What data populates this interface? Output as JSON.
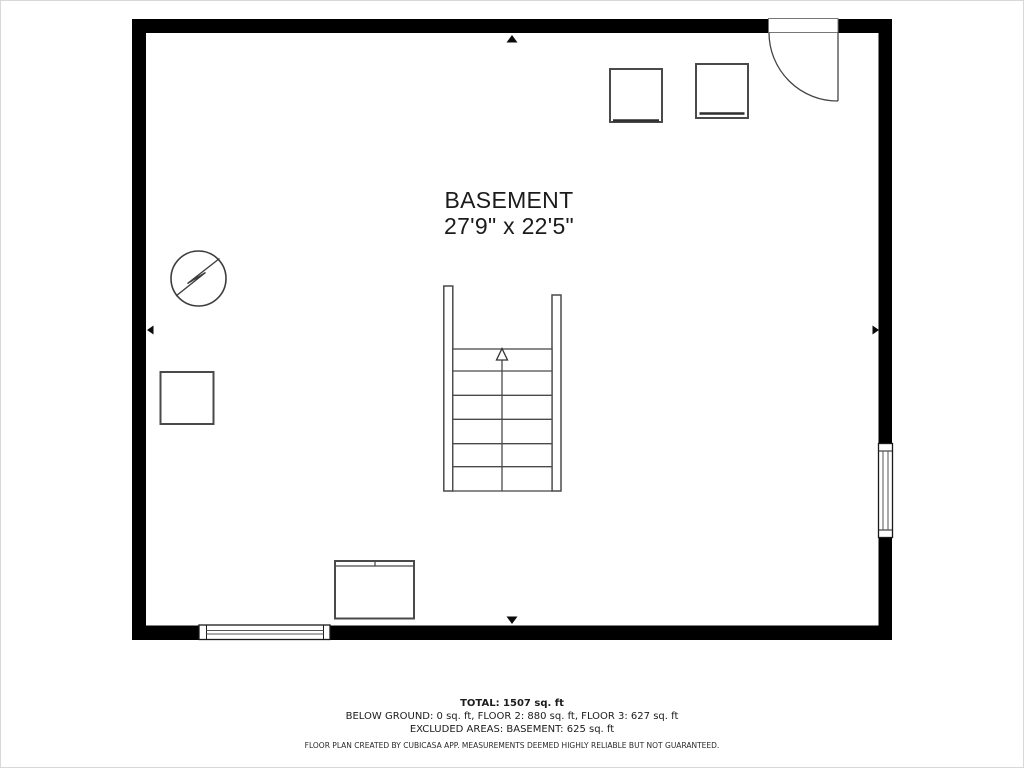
{
  "room": {
    "label": "BASEMENT",
    "dimensions": "27'9\" x 22'5\""
  },
  "footer": {
    "total": "TOTAL: 1507 sq. ft",
    "breakdown": "BELOW GROUND: 0 sq. ft, FLOOR 2: 880 sq. ft, FLOOR 3: 627 sq. ft",
    "excluded": "EXCLUDED AREAS: BASEMENT: 625 sq. ft",
    "disclaimer": "FLOOR PLAN CREATED BY CUBICASA APP. MEASUREMENTS DEEMED HIGHLY RELIABLE BUT NOT GUARANTEED."
  },
  "icons": {
    "electrical": "circle-lightning-bolt-symbol",
    "stairs": "staircase-with-up-arrow",
    "door": "quarter-swing-door-top-right",
    "windows": [
      "bottom-wall-window",
      "right-wall-window"
    ],
    "wall_markers": "midpoint-arrow-triangles",
    "furniture": [
      "appliance-square-1",
      "appliance-square-2",
      "storage-square",
      "dresser-rectangle"
    ]
  },
  "colors": {
    "wall": "#000000",
    "symbol_stroke": "#4a4a4a",
    "text": "#1c1c1c",
    "background": "#ffffff"
  }
}
